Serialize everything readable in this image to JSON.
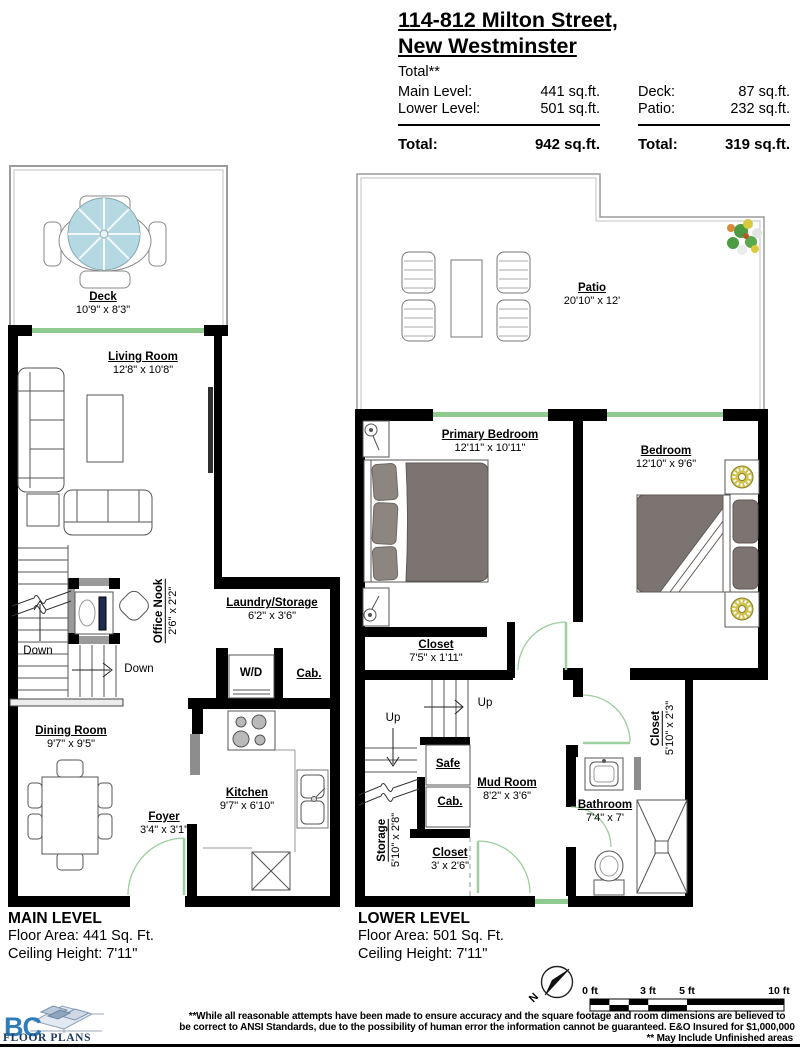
{
  "header": {
    "address_line1": "114-812 Milton Street,",
    "address_line2": "New Westminster",
    "areas": {
      "total_note": "Total**",
      "left_rows": [
        {
          "label": "Main Level:",
          "value": "441 sq.ft."
        },
        {
          "label": "Lower Level:",
          "value": "501 sq.ft."
        }
      ],
      "left_total": {
        "label": "Total:",
        "value": "942 sq.ft."
      },
      "right_rows": [
        {
          "label": "Deck:",
          "value": "87 sq.ft."
        },
        {
          "label": "Patio:",
          "value": "232 sq.ft."
        }
      ],
      "right_total": {
        "label": "Total:",
        "value": "319 sq.ft."
      }
    }
  },
  "rooms": {
    "deck": {
      "name": "Deck",
      "dims": "10'9\" x 8'3\""
    },
    "living_room": {
      "name": "Living Room",
      "dims": "12'8\" x 10'8\""
    },
    "office_nook": {
      "name": "Office Nook",
      "dims": "2'6\" x 2'2\""
    },
    "dining_room": {
      "name": "Dining Room",
      "dims": "9'7\" x 9'5\""
    },
    "laundry": {
      "name": "Laundry/Storage",
      "dims": "6'2\" x 3'6\""
    },
    "kitchen": {
      "name": "Kitchen",
      "dims": "9'7\" x 6'10\""
    },
    "foyer": {
      "name": "Foyer",
      "dims": "3'4\" x 3'1\""
    },
    "patio": {
      "name": "Patio",
      "dims": "20'10\" x 12'"
    },
    "primary_bedroom": {
      "name": "Primary Bedroom",
      "dims": "12'11\" x 10'11\""
    },
    "bedroom": {
      "name": "Bedroom",
      "dims": "12'10\" x 9'6\""
    },
    "closet_primary": {
      "name": "Closet",
      "dims": "7'5\" x 1'11\""
    },
    "mud_room": {
      "name": "Mud Room",
      "dims": "8'2\" x 3'6\""
    },
    "storage": {
      "name": "Storage",
      "dims": "5'10\" x 2'8\""
    },
    "closet_small": {
      "name": "Closet",
      "dims": "3' x 2'6\""
    },
    "closet_bedroom": {
      "name": "Closet",
      "dims": "5'10\" x 2'3\""
    },
    "bathroom": {
      "name": "Bathroom",
      "dims": "7'4\" x 7'"
    }
  },
  "annotations": {
    "down": "Down",
    "up": "Up",
    "wd": "W/D",
    "cab": "Cab.",
    "safe": "Safe"
  },
  "levels": {
    "main": {
      "title": "MAIN LEVEL",
      "floor_area": "Floor Area: 441 Sq. Ft.",
      "ceiling": "Ceiling Height: 7'11\""
    },
    "lower": {
      "title": "LOWER LEVEL",
      "floor_area": "Floor Area: 501 Sq. Ft.",
      "ceiling": "Ceiling Height: 7'11\""
    }
  },
  "footer": {
    "logo_bc": "BC",
    "logo_text": "FLOOR PLANS",
    "north_label": "N",
    "scale_labels": [
      "0 ft",
      "3 ft",
      "5 ft",
      "10 ft"
    ],
    "disclaimer_line1": "**While all reasonable attempts have been made to ensure accuracy and the square footage and room dimensions are believed to",
    "disclaimer_line2": "be correct to ANSI Standards, due to the possibility of human error the information cannot be guaranteed. E&O Insured for $1,000,000",
    "disclaimer_line3": "** May Include Unfinished areas"
  },
  "colors": {
    "wall": "#000000",
    "door_window_green": "#8fca8f",
    "umbrella_blue": "#b5d9e3",
    "bed_gray": "#7b7470",
    "lamp_yellow": "#cfc34e",
    "logo_blue": "#2e7cb8",
    "logo_navy": "#1c3a5e"
  }
}
